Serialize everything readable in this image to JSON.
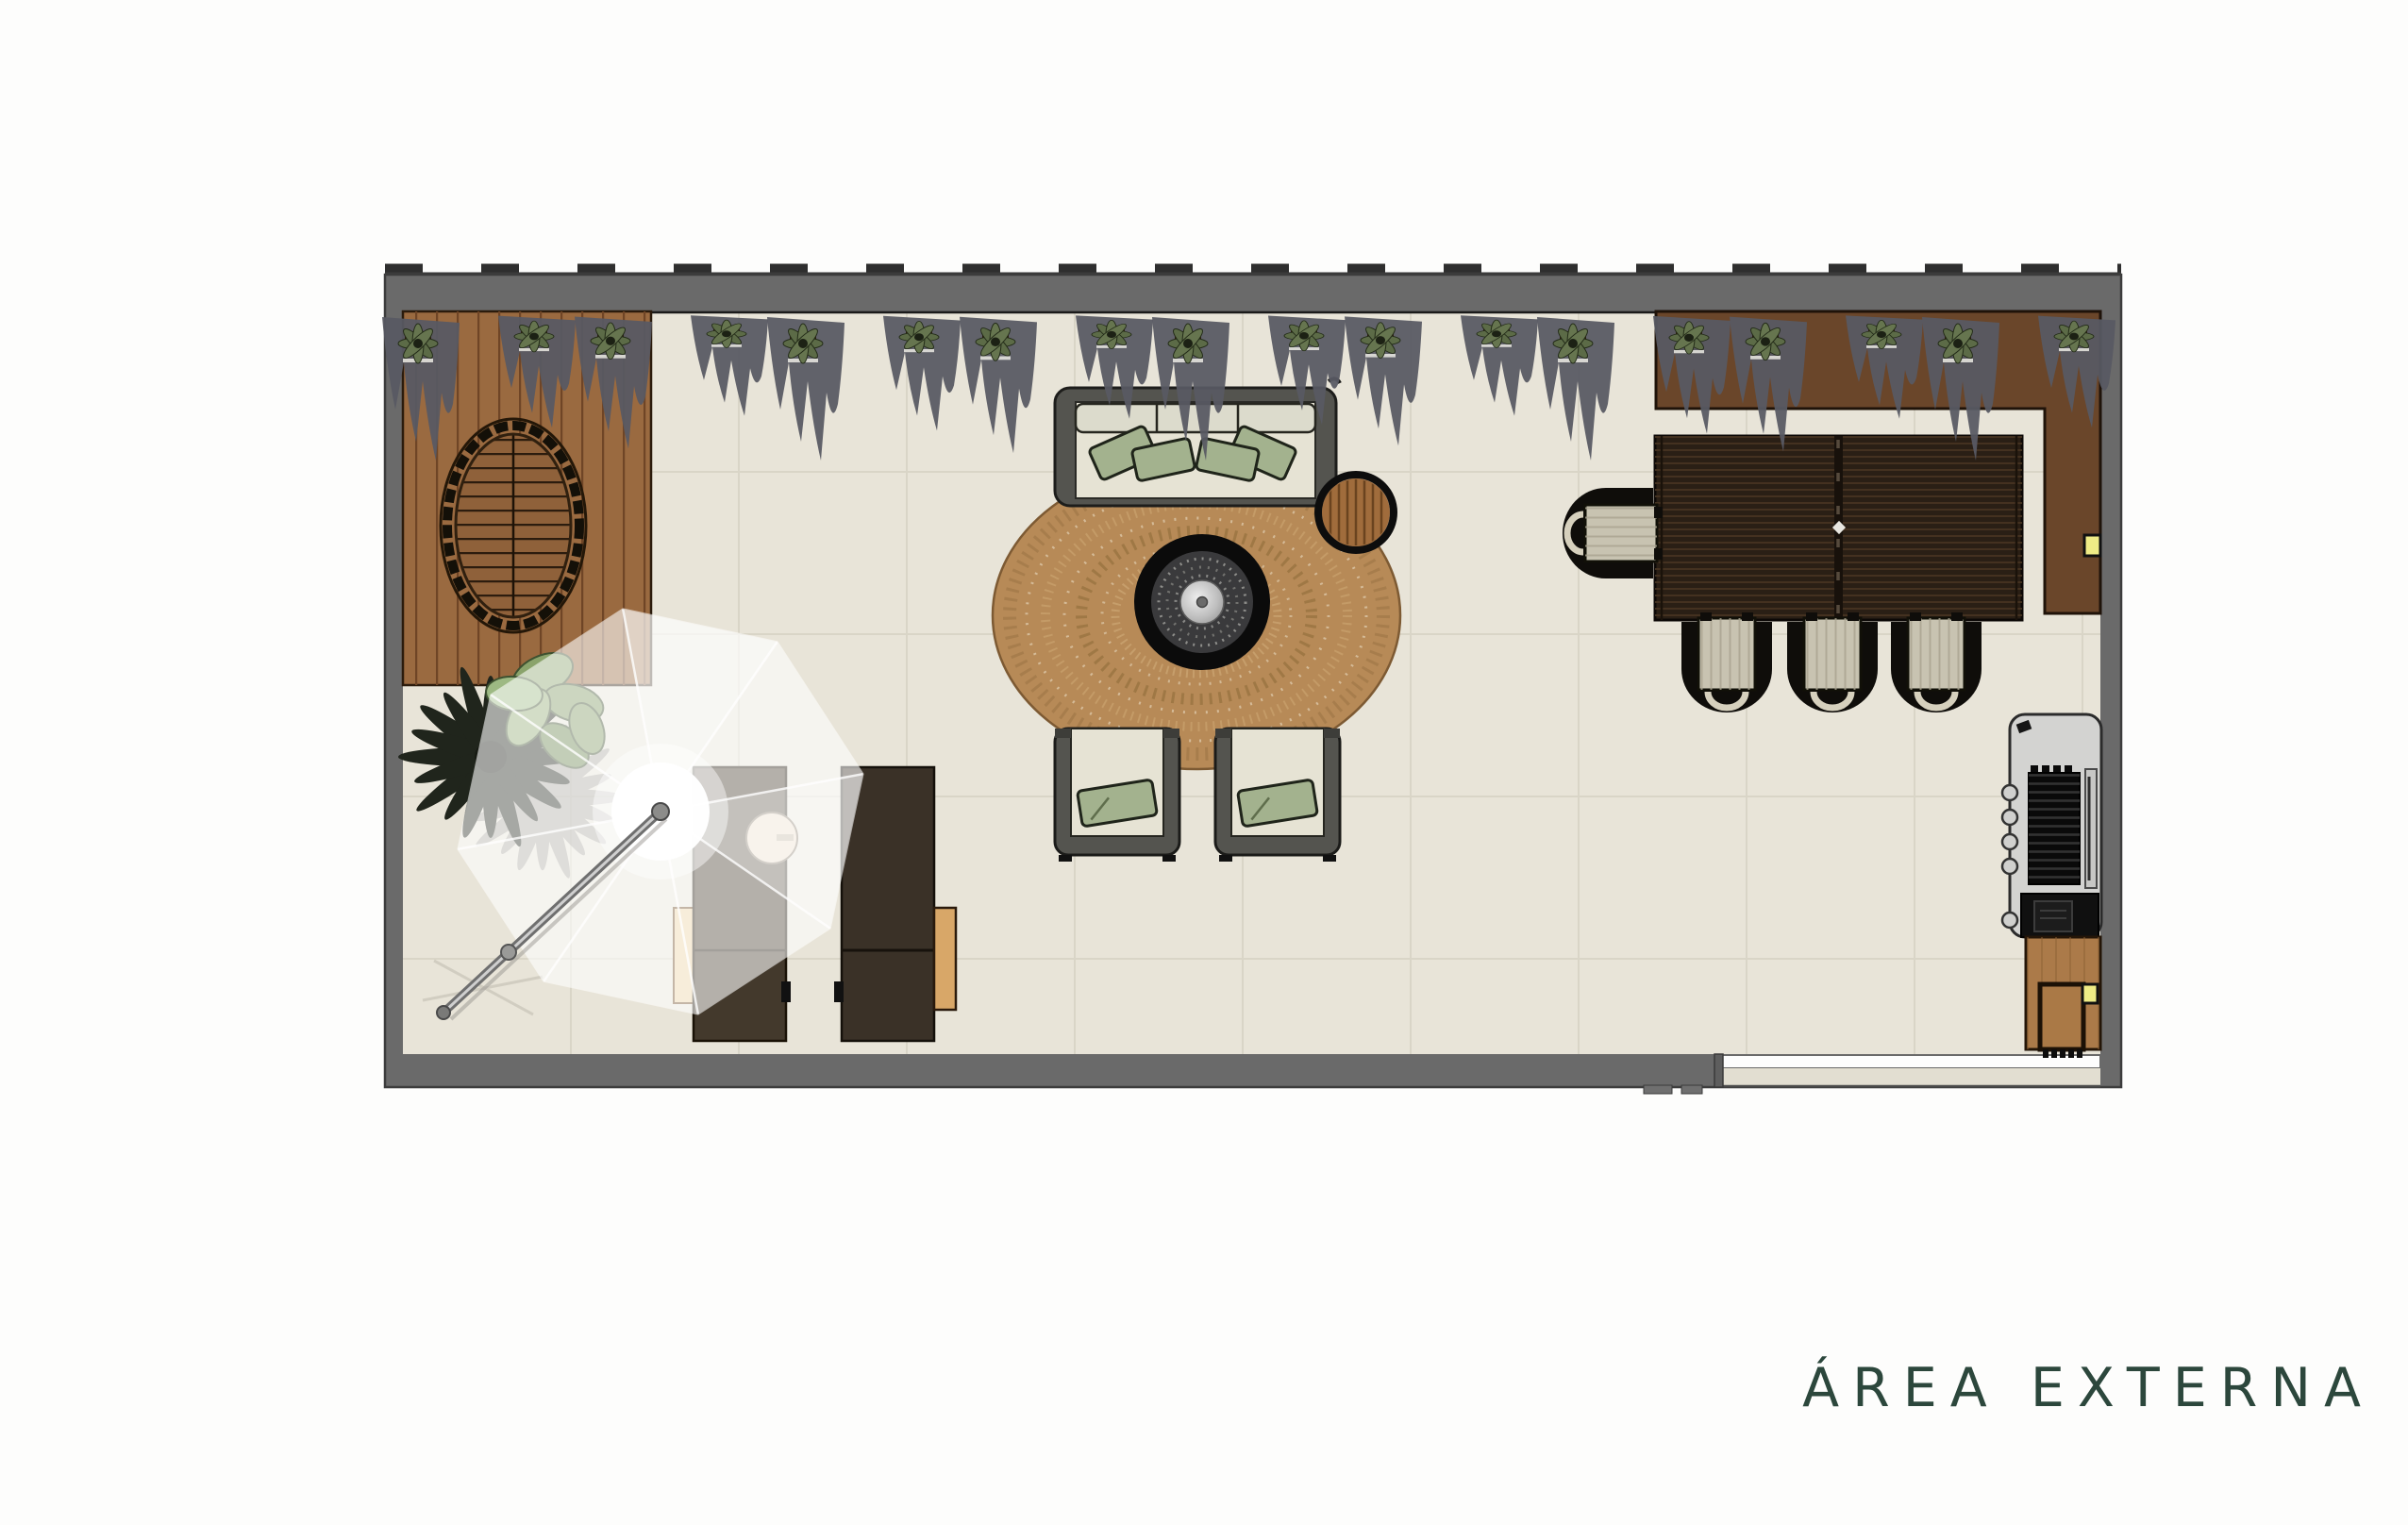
{
  "title": {
    "text": "ÁREA EXTERNA"
  },
  "planters": {
    "count": 18
  },
  "colors": {
    "page_bg": "#fdfdfc",
    "wall": "#6a6a6a",
    "wall_outline": "#3a3a3a",
    "floor": "#e8e4d8",
    "tile_line": "#d8d4c6",
    "deck_wood": "#9a6a40",
    "deck_border": "#6a462a",
    "rug": "#b78a57",
    "sofa_frame": "#54544f",
    "cushion": "#e6e3d4",
    "back_cushion": "#dcdbcc",
    "pillow_green": "#a3b28e",
    "fire_ring": "#0b0b0b",
    "gravel": "#3a3a3c",
    "steel": "#c9c9c7",
    "table_wood": "#2a1f15",
    "chair_black": "#0f0d0a",
    "chair_seat": "#c8c3b1",
    "grill_body": "#d3d3d1",
    "cabinet_wood": "#ab7a49",
    "accent_yellow": "#efec86",
    "lounger_dark": "#3a3127",
    "lounger_shaded": "#43392c",
    "wood_light": "#ecd2a4",
    "wood_mid": "#d8a768",
    "umbrella_white": "#ffffff",
    "palm_dark": "#20251c",
    "leaf_green": "#7f9a63",
    "foliage_gray": "#585963",
    "title_green": "#2c473c"
  }
}
